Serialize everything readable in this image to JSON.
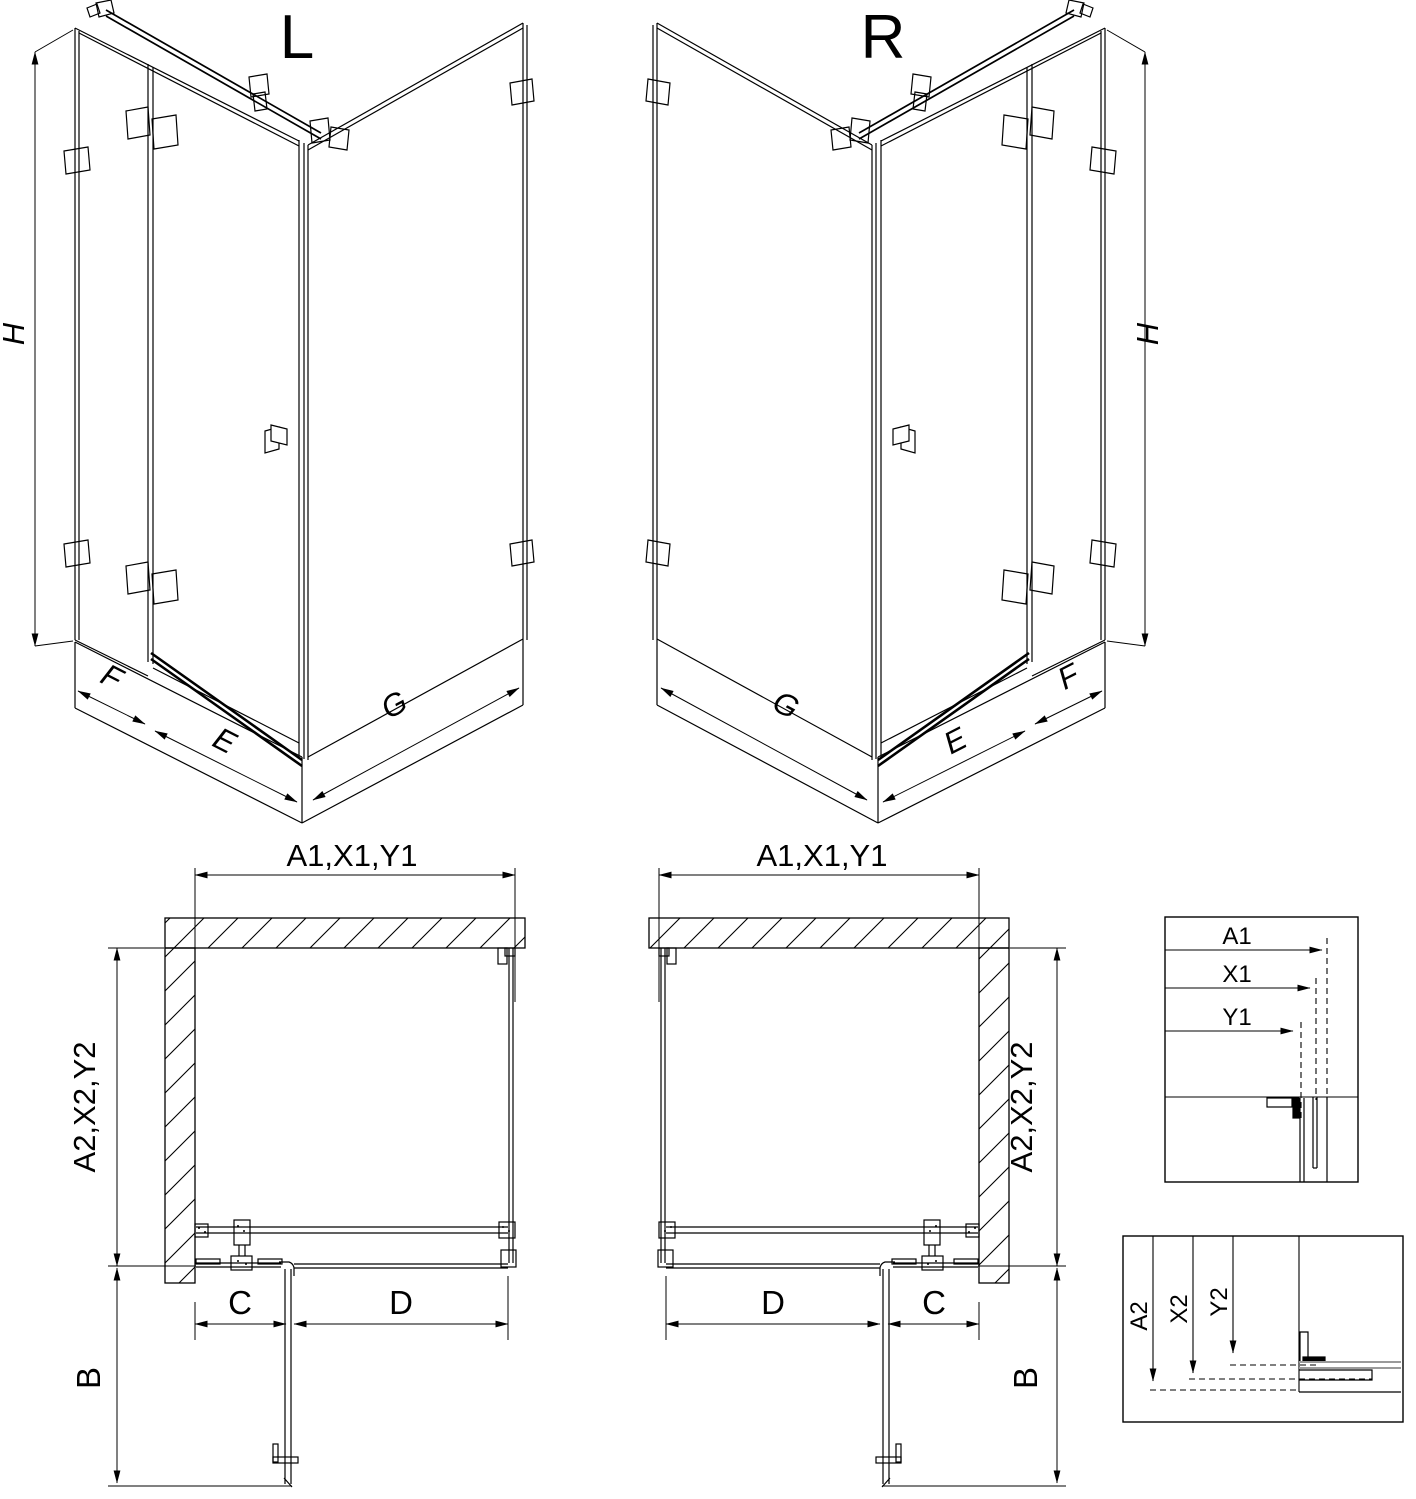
{
  "drawing": {
    "iso_left": {
      "variant": "L",
      "height": "H",
      "back_panel": "F",
      "door": "E",
      "side_panel": "G"
    },
    "iso_right": {
      "variant": "R",
      "height": "H",
      "back_panel": "F",
      "door": "E",
      "side_panel": "G"
    },
    "plan_left": {
      "top_width": "A1,X1,Y1",
      "side_depth": "A2,X2,Y2",
      "door_swing": "B",
      "front_fixed": "C",
      "side_panel": "D"
    },
    "plan_right": {
      "top_width": "A1,X1,Y1",
      "side_depth": "A2,X2,Y2",
      "door_swing": "B",
      "front_fixed": "C",
      "side_panel": "D"
    },
    "detail_width": {
      "labels": [
        "A1",
        "X1",
        "Y1"
      ]
    },
    "detail_depth": {
      "labels": [
        "A2",
        "X2",
        "Y2"
      ]
    },
    "colors": {
      "line": "#000000",
      "glass_gray": "#9a9a9a",
      "background": "#ffffff"
    }
  }
}
